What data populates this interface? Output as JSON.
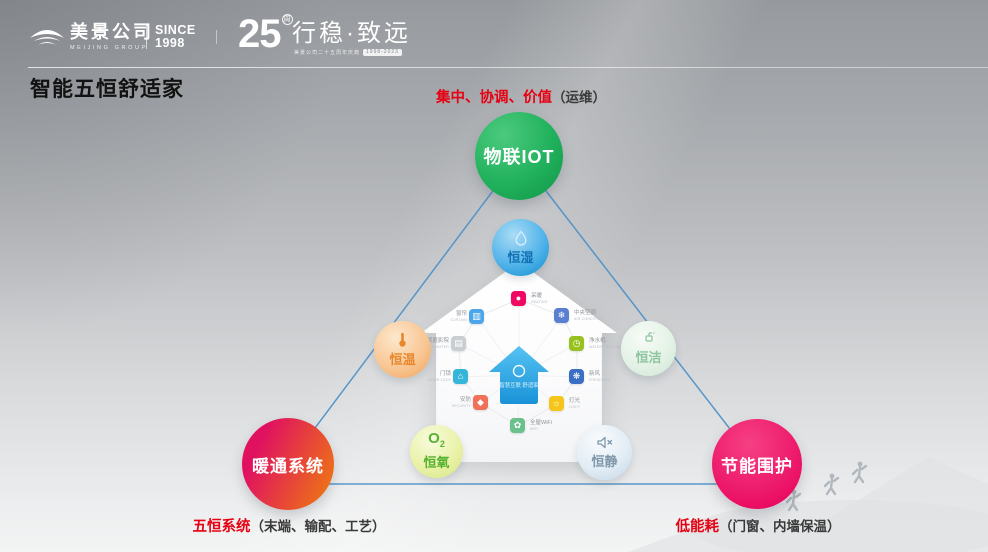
{
  "header": {
    "company": "美景公司",
    "company_en": "MEIJING GROUP",
    "since_line1": "SINCE",
    "since_line2": "1998",
    "anniversary_number": "25",
    "anniversary_sup": "周",
    "slogan": "行稳·致远",
    "slogan_sub": "美景公司二十五周年庆典",
    "slogan_badge": "1998-2023"
  },
  "title": "智能五恒舒适家",
  "diagram": {
    "top_label": {
      "highlight": "集中、协调、价值",
      "normal": "（运维）"
    },
    "bottom_left_label": {
      "highlight": "五恒系统",
      "normal": "（末端、输配、工艺）"
    },
    "bottom_right_label": {
      "highlight": "低能耗",
      "normal": "（门窗、内墙保温）"
    },
    "nodes": {
      "iot": "物联IOT",
      "hvac": "暖通系统",
      "envelope": "节能围护"
    },
    "constants": {
      "humidity": {
        "label": "恒湿"
      },
      "temperature": {
        "label": "恒温"
      },
      "clean": {
        "label": "恒洁"
      },
      "oxygen": {
        "label": "恒氧",
        "icon_text": "O"
      },
      "quiet": {
        "label": "恒静"
      }
    },
    "house": {
      "center_title": "智慧互联 舒适家",
      "apps": [
        {
          "cn": "采暖",
          "en": "HEATING",
          "glyph": "●"
        },
        {
          "cn": "窗帘",
          "en": "CURTAIN",
          "glyph": "▥"
        },
        {
          "cn": "中央空调",
          "en": "AIR CONDITION",
          "glyph": "❄"
        },
        {
          "cn": "家庭影院",
          "en": "HOME THEATER",
          "glyph": "▤"
        },
        {
          "cn": "净水机",
          "en": "WATER TREATMENT",
          "glyph": "◷"
        },
        {
          "cn": "门锁",
          "en": "DOOR LOCK",
          "glyph": "⌂"
        },
        {
          "cn": "新风",
          "en": "FRESH AIR",
          "glyph": "❋"
        },
        {
          "cn": "安防",
          "en": "SECURITY",
          "glyph": "◆"
        },
        {
          "cn": "灯光",
          "en": "LIGHT",
          "glyph": "☼"
        },
        {
          "cn": "全屋WiFi",
          "en": "WIFI",
          "glyph": "✿"
        }
      ]
    }
  },
  "palette": {
    "accent_red_label": "#e60012",
    "iot_green": "#1fae59",
    "hvac_gradient": [
      "#e01260",
      "#ee7a10"
    ],
    "envelope_pink": "#ea0c62",
    "humidity_blue": "#2f9fdc",
    "temperature_orange": "#f3ab66",
    "clean_green": "#cfe7d6",
    "oxygen_yellowgreen": "#dfeb95",
    "quiet_blue": "#cfdfeb",
    "triangle_line_blue": "#4a8fc7"
  }
}
